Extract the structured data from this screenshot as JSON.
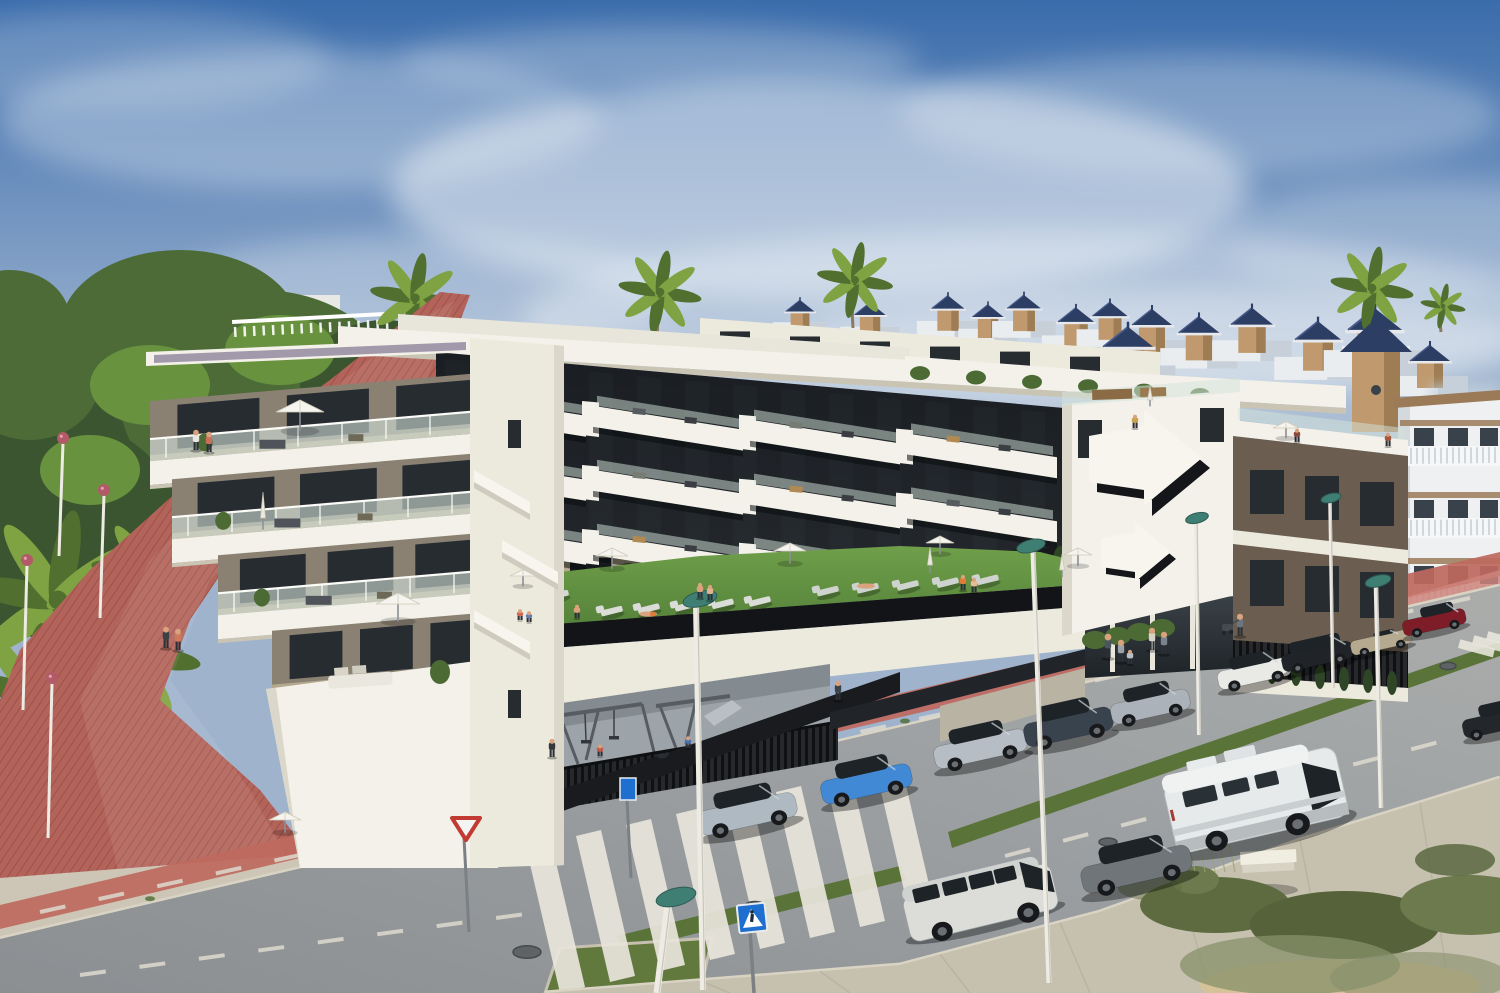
{
  "palette": {
    "skyTop": "#3a6cab",
    "skyMid": "#7d9cc4",
    "skyLow": "#c9d2dc",
    "cloud": "#f2f5f8",
    "pineDark": "#3a5530",
    "pineMid": "#4c6b37",
    "pineLight": "#69923f",
    "palm": "#7fa342",
    "palmDark": "#516f2e",
    "trunk": "#8a7a60",
    "villaRoof": "#2c3e63",
    "villaRoofLight": "#4a5c8e",
    "villaWall": "#eaedf0",
    "villaWallShade": "#c7cfd9",
    "villaTower": "#c09a6e",
    "villaTowerShade": "#9e7d54",
    "medWall": "#eef0f2",
    "medShade": "#d3d9dd",
    "medTile": "#9b7a58",
    "medWin": "#39424a",
    "balustrade": "#f6f7f8",
    "white": "#f3f1e9",
    "whiteShade": "#dbd7ca",
    "cream": "#ece9dd",
    "parapetShadow": "#c9c4b4",
    "facade": "#17191d",
    "facade2": "#24272c",
    "glass": "#272c31",
    "glassLight": "#39414a",
    "terrWall": "#8a8173",
    "terrWall2": "#79725f",
    "terrFloor": "#b5a88c",
    "gravel": "#a29aab",
    "railGlass": "#d3e3da",
    "railPost": "#fbfbf7",
    "lawn": "#5c8c3c",
    "lawnLight": "#78a650",
    "hedge": "#2e4626",
    "hedgeLight": "#4c6b34",
    "fenceDark": "#1b1d20",
    "equip": "#565c62",
    "playFloor": "#9ca4aa",
    "brown": "#6b5e50",
    "brownDark": "#57493c",
    "asphalt": "#9a9ea1",
    "asphaltDark": "#8a8e90",
    "asphaltLight": "#a9abaa",
    "sidewalk": "#cdc6b6",
    "sidewalk2": "#c6c0af",
    "curb": "#d9d3c3",
    "joint": "#b5ae9c",
    "bikeRed": "#bf695e",
    "bikeRedLight": "#cd837a",
    "promRed": "#b2635a",
    "promRedDark": "#a05048",
    "median": "#5a7339",
    "grassIsland": "#61793d",
    "stripe": "#e8e5db",
    "signBlue": "#1f6fd0",
    "signGrey": "#7b8085",
    "poleWhite": "#edebe4",
    "poleShade": "#b9b5aa",
    "lampTeal": "#3f7e73",
    "lampTealDark": "#2d5c54",
    "lampPink": "#b25a68",
    "benchTop": "#f0ede1",
    "benchSide": "#d7d3c5",
    "scrub1": "#5e6b40",
    "scrub2": "#55623a",
    "scrub3": "#6d7a4e",
    "scrub4": "#87906a",
    "sand": "#d6c298",
    "stems": "#9aa077",
    "skin": "#d8a37e",
    "pants": "#2b2f36",
    "carGlass": "#1d2327",
    "tyre": "#17191c"
  },
  "sky": {
    "clouds": [
      [
        300,
        120,
        300,
        70,
        0.32
      ],
      [
        820,
        190,
        430,
        110,
        0.5
      ],
      [
        1200,
        115,
        300,
        60,
        0.28
      ],
      [
        1040,
        320,
        520,
        90,
        0.4
      ],
      [
        420,
        295,
        260,
        60,
        0.3
      ],
      [
        120,
        60,
        210,
        50,
        0.22
      ],
      [
        660,
        60,
        260,
        34,
        0.28
      ],
      [
        1420,
        240,
        200,
        60,
        0.25
      ],
      [
        1160,
        340,
        360,
        50,
        0.35
      ]
    ]
  },
  "background": {
    "villas": [
      [
        800,
        318,
        0.72,
        0
      ],
      [
        870,
        322,
        0.78,
        0
      ],
      [
        948,
        316,
        0.82,
        0
      ],
      [
        988,
        324,
        0.78,
        0
      ],
      [
        1024,
        316,
        0.84,
        0
      ],
      [
        1076,
        330,
        0.9,
        0
      ],
      [
        1110,
        324,
        0.88,
        0
      ],
      [
        1152,
        334,
        1.0,
        0
      ],
      [
        1199,
        342,
        1.02,
        0
      ],
      [
        1252,
        334,
        1.05,
        0
      ],
      [
        1318,
        350,
        1.15,
        0
      ],
      [
        1128,
        358,
        1.25,
        1
      ],
      [
        1375,
        342,
        1.35,
        1
      ],
      [
        1430,
        370,
        1.0,
        0
      ]
    ],
    "tall_palms": [
      [
        415,
        298,
        58,
        26
      ],
      [
        660,
        292,
        54,
        24
      ],
      [
        855,
        280,
        48,
        22
      ],
      [
        1372,
        288,
        55,
        24
      ],
      [
        1443,
        306,
        26,
        13
      ]
    ],
    "palm_fans": [
      [
        58,
        600,
        52
      ],
      [
        128,
        652,
        42
      ],
      [
        30,
        692,
        40
      ],
      [
        150,
        575,
        34
      ]
    ],
    "pines": [
      [
        120,
        430,
        150,
        120,
        "pineDark"
      ],
      [
        260,
        400,
        140,
        110,
        "pineMid"
      ],
      [
        60,
        530,
        120,
        110,
        "pineDark"
      ],
      [
        330,
        465,
        115,
        90,
        "pineMid"
      ],
      [
        180,
        330,
        120,
        80,
        "pineMid"
      ],
      [
        385,
        390,
        85,
        70,
        "pineDark"
      ],
      [
        30,
        380,
        70,
        60,
        "pineMid"
      ],
      [
        10,
        320,
        60,
        50,
        "pineMid"
      ],
      [
        230,
        490,
        80,
        55,
        "pineDark"
      ],
      [
        150,
        385,
        60,
        40,
        "pineLight"
      ],
      [
        280,
        350,
        55,
        35,
        "pineLight"
      ],
      [
        90,
        470,
        50,
        35,
        "pineLight"
      ],
      [
        350,
        430,
        45,
        30,
        "pineLight"
      ]
    ]
  },
  "complex": {
    "left_block_floors": [
      {
        "lx": 150,
        "ry": 372
      },
      {
        "lx": 172,
        "ry": 452
      },
      {
        "lx": 218,
        "ry": 532
      },
      {
        "lx": 272,
        "ry": 612,
        "ground": true
      }
    ],
    "center_rows": [
      392,
      456,
      520
    ],
    "lounger_rows": [
      {
        "x": 612,
        "y": 612,
        "n": 5,
        "dx": 37,
        "dy": -2.4,
        "c": "#dadcd8"
      },
      {
        "x": 828,
        "y": 592,
        "n": 5,
        "dx": 40,
        "dy": -2.8,
        "c": "#cfd3cf"
      },
      {
        "x": 528,
        "y": 598,
        "n": 2,
        "dx": 30,
        "dy": -2,
        "c": "#d6d8d4"
      }
    ],
    "back_cypresses": [
      [
        852,
        586
      ],
      [
        878,
        583
      ],
      [
        904,
        580
      ],
      [
        930,
        577
      ],
      [
        956,
        574
      ],
      [
        982,
        571
      ],
      [
        1008,
        568
      ],
      [
        1034,
        565
      ],
      [
        1060,
        562
      ]
    ],
    "front_cypresses": [
      [
        1248,
        670
      ],
      [
        1272,
        672
      ],
      [
        1296,
        674
      ],
      [
        1320,
        677
      ],
      [
        1344,
        679
      ],
      [
        1368,
        681
      ],
      [
        1392,
        683
      ]
    ],
    "bushes": [
      [
        1095,
        640
      ],
      [
        1118,
        636
      ],
      [
        1140,
        632
      ],
      [
        1162,
        628
      ]
    ]
  },
  "street": {
    "cars": [
      {
        "name": "hatchback-silver-blue",
        "kind": "hatch",
        "color": "#aeb9c1",
        "roof": "dark",
        "x": 747,
        "y": 812,
        "w": 100,
        "h": 48,
        "rot": -12.5
      },
      {
        "name": "city-car-blue",
        "kind": "hatch",
        "color": "#4189d4",
        "roof": "dark",
        "x": 866,
        "y": 782,
        "w": 92,
        "h": 46,
        "rot": -12.5
      },
      {
        "name": "hatchback-silver",
        "kind": "hatch",
        "color": "#b6bdc4",
        "roof": "dark",
        "x": 980,
        "y": 747,
        "w": 94,
        "h": 44,
        "rot": -12.5
      },
      {
        "name": "suv-dark-blue",
        "kind": "suv",
        "color": "#39434e",
        "roof": "dark",
        "x": 1068,
        "y": 725,
        "w": 90,
        "h": 46,
        "rot": -12.5
      },
      {
        "name": "hatchback-light-silver",
        "kind": "hatch",
        "color": "#abb2b9",
        "roof": "dark",
        "x": 1150,
        "y": 705,
        "w": 80,
        "h": 40,
        "rot": -12.5
      },
      {
        "name": "hatchback-white-dark-roof",
        "kind": "hatch",
        "color": "#e9eae6",
        "roof": "dark",
        "x": 1254,
        "y": 672,
        "w": 74,
        "h": 36,
        "rot": -12.5
      },
      {
        "name": "estate-black",
        "kind": "wagon",
        "color": "#202428",
        "roof": "dark",
        "x": 1317,
        "y": 655,
        "w": 72,
        "h": 34,
        "rot": -12.5
      },
      {
        "name": "convertible-champagne",
        "kind": "convertible",
        "color": "#b5aa90",
        "roof": "dark",
        "x": 1381,
        "y": 641,
        "w": 62,
        "h": 28,
        "rot": -12.5
      },
      {
        "name": "sedan-dark-red",
        "kind": "sedan",
        "color": "#7e1c28",
        "roof": "dark",
        "x": 1434,
        "y": 621,
        "w": 64,
        "h": 30,
        "rot": -12.5
      },
      {
        "name": "car-dark-partial",
        "kind": "sedan",
        "color": "#23262b",
        "roof": "dark",
        "x": 1492,
        "y": 722,
        "w": 60,
        "h": 36,
        "rot": -12.5
      },
      {
        "name": "camper-van-white",
        "kind": "camper",
        "color": "#e7eaea",
        "roof": "body",
        "x": 1256,
        "y": 800,
        "w": 176,
        "h": 94,
        "rot": -13
      },
      {
        "name": "hatchback-grey",
        "kind": "hatch",
        "color": "#70757a",
        "roof": "dark",
        "x": 1136,
        "y": 867,
        "w": 112,
        "h": 52,
        "rot": -13
      },
      {
        "name": "minivan-silver-white",
        "kind": "van",
        "color": "#dcddd9",
        "roof": "body",
        "x": 980,
        "y": 900,
        "w": 152,
        "h": 62,
        "rot": -13.5
      }
    ],
    "lamps": [
      [
        700,
        599,
        696,
        604,
        703,
        990,
        6
      ],
      [
        676,
        897,
        668,
        904,
        657,
        993,
        7
      ],
      [
        1031,
        546,
        1033,
        552,
        1049,
        983,
        5
      ],
      [
        1197,
        518,
        1196,
        523,
        1199,
        735,
        4
      ],
      [
        1378,
        581,
        1376,
        587,
        1381,
        808,
        4.5
      ],
      [
        1331,
        498,
        1330,
        503,
        1333,
        688,
        3.5
      ]
    ],
    "pink_lamps": [
      [
        63,
        438,
        118
      ],
      [
        104,
        490,
        128
      ],
      [
        27,
        560,
        150
      ],
      [
        52,
        678,
        160
      ]
    ],
    "zebra": {
      "count": 8,
      "x0": 560,
      "y0": 993,
      "dx": 50,
      "dy": -11
    },
    "mini_zebra": [
      [
        1458,
        648
      ],
      [
        1472,
        644
      ],
      [
        1486,
        640
      ],
      [
        1499,
        637
      ]
    ],
    "dashes": [
      [
        40,
        912,
        1470,
        598
      ],
      [
        80,
        975,
        540,
        912
      ],
      [
        1005,
        856,
        1500,
        726
      ]
    ],
    "manholes": [
      [
        527,
        952,
        14
      ],
      [
        755,
        906,
        10
      ],
      [
        1108,
        842,
        9
      ],
      [
        1448,
        666,
        8
      ]
    ],
    "tuft_xs": [
      150,
      520,
      760,
      905,
      1065,
      1345
    ],
    "joint_xs": [
      700,
      820,
      940,
      1060,
      1180,
      1300,
      1420
    ]
  },
  "people": [
    [
      196,
      450,
      20,
      "#e9e7e1"
    ],
    [
      209,
      452,
      20,
      "#c96f5a"
    ],
    [
      166,
      648,
      21,
      "#3c4148"
    ],
    [
      178,
      650,
      21,
      "#cf7a5e"
    ],
    [
      552,
      757,
      18,
      "#34383f"
    ],
    [
      1135,
      428,
      13,
      "#c9a24d"
    ],
    [
      1297,
      442,
      13,
      "#8a4a3c"
    ],
    [
      1388,
      446,
      13,
      "#a5563e"
    ],
    [
      700,
      598,
      15,
      "#d8a37e"
    ],
    [
      710,
      600,
      15,
      "#e2b28e"
    ],
    [
      963,
      590,
      15,
      "#e07b3a"
    ],
    [
      974,
      592,
      14,
      "#e6bb97"
    ],
    [
      577,
      618,
      13,
      "#d8a37e"
    ],
    [
      520,
      620,
      10,
      "#cf6a50"
    ],
    [
      529,
      622,
      10,
      "#5f7fb5"
    ],
    [
      600,
      756,
      11,
      "#c9574a"
    ],
    [
      688,
      748,
      11,
      "#4a6fb3"
    ],
    [
      838,
      700,
      19,
      "#3c424a"
    ],
    [
      1108,
      658,
      24,
      "#4b5560"
    ],
    [
      1121,
      662,
      22,
      "#99a1a9"
    ],
    [
      1130,
      664,
      14,
      "#b8bfc6"
    ],
    [
      1152,
      650,
      22,
      "#d8d3c9"
    ],
    [
      1164,
      654,
      22,
      "#7a838c"
    ],
    [
      1240,
      636,
      22,
      "#6b7480"
    ]
  ],
  "people_lying": [
    [
      648,
      614,
      "#e07b3a"
    ],
    [
      866,
      586,
      "#d8a37e"
    ]
  ],
  "umbrellas": {
    "open": [
      [
        300,
        412,
        24
      ],
      [
        398,
        604,
        22
      ],
      [
        285,
        820,
        16
      ],
      [
        612,
        556,
        16
      ],
      [
        790,
        551,
        16
      ],
      [
        940,
        543,
        14
      ],
      [
        1078,
        555,
        14
      ],
      [
        1286,
        428,
        13
      ],
      [
        523,
        576,
        13
      ]
    ],
    "closed": [
      [
        263,
        518,
        26
      ],
      [
        930,
        565,
        18
      ],
      [
        1062,
        570,
        16
      ],
      [
        1150,
        400,
        14
      ]
    ]
  },
  "scrub": [
    [
      1215,
      905,
      75,
      28,
      "scrub1",
      1
    ],
    [
      1345,
      925,
      95,
      34,
      "scrub2",
      1
    ],
    [
      1470,
      905,
      70,
      30,
      "scrub3",
      1
    ],
    [
      1290,
      965,
      110,
      30,
      "scrub4",
      0.75
    ],
    [
      1420,
      978,
      90,
      26,
      "scrub4",
      0.6
    ],
    [
      1195,
      880,
      24,
      14,
      "scrub3",
      1
    ],
    [
      1150,
      888,
      32,
      12,
      "scrub1",
      0.5
    ],
    [
      1455,
      860,
      40,
      16,
      "scrub2",
      0.8
    ]
  ],
  "bench": {
    "x": 1242,
    "y": 852
  }
}
